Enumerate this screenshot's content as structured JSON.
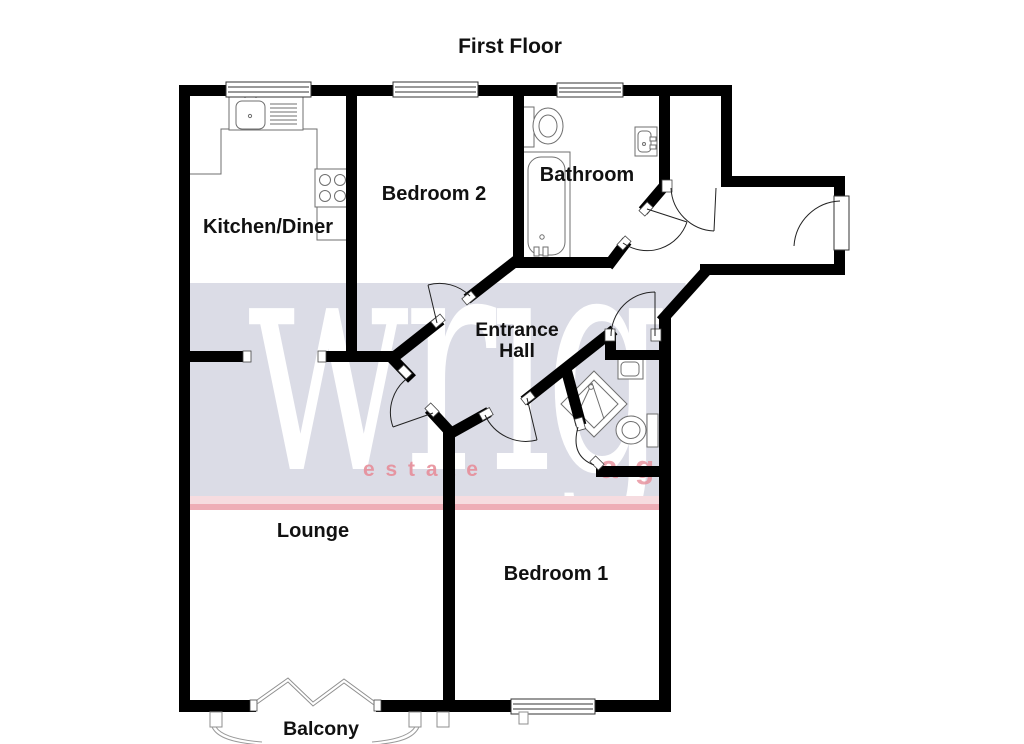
{
  "plan": {
    "title": "First Floor",
    "rooms": {
      "kitchen": "Kitchen/Diner",
      "bedroom2": "Bedroom 2",
      "bathroom": "Bathroom",
      "entrance1": "Entrance",
      "entrance2": "Hall",
      "lounge": "Lounge",
      "bedroom1": "Bedroom 1",
      "balcony": "Balcony"
    },
    "watermark": {
      "word": "wrigh",
      "tagline": "e s t a t e",
      "tagline_extra": "a g",
      "band_color": "#dbdce6",
      "stripe_light": "#f6dce0",
      "stripe_strong": "#eeadb6",
      "word_color": "#ffffff",
      "tagline_color": "#e78e9a"
    },
    "colors": {
      "wall": "#000000",
      "label": "#111111",
      "fixture": "#6f6f6f",
      "door_arc": "#222222",
      "window_frame": "#333333"
    }
  }
}
